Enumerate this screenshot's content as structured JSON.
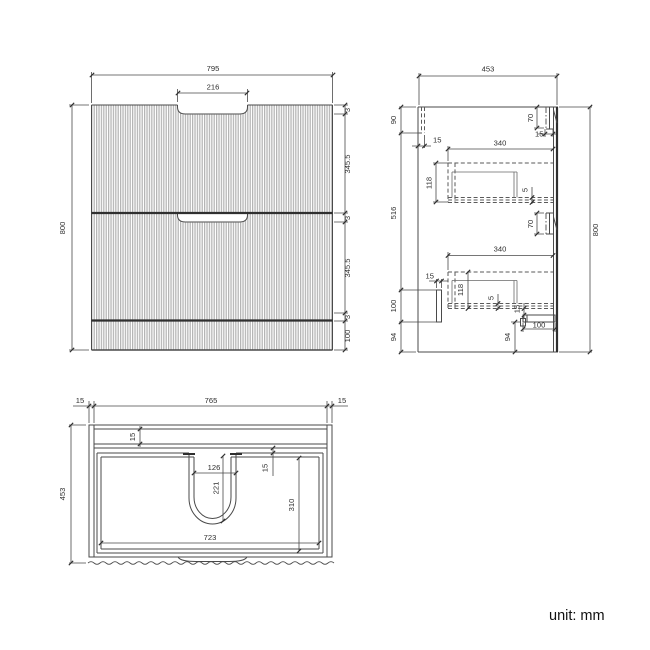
{
  "front_view": {
    "width": "795",
    "handle_cutout_width": "216",
    "height": "800",
    "gap_top": "3",
    "drawer1_height": "345.5",
    "gap_middle": "3",
    "drawer2_height": "345.5",
    "gap_bottom": "3",
    "plinth_height": "100"
  },
  "side_view": {
    "depth": "453",
    "height": "800",
    "back_rail_height": "90",
    "mid_section_height": "516",
    "bottom_rail_height": "100",
    "base_height": "94",
    "back_rail_thickness": "15",
    "handle1_height": "70",
    "handle_depth": "15",
    "drawer1_length": "340",
    "drawer1_inner_height": "118",
    "drawer1_bottom_gap": "5",
    "handle2_height": "70",
    "drawer2_length": "340",
    "drawer2_inner_height": "118",
    "drawer2_bottom_gap": "5",
    "drawer2_front_gap": "15",
    "bottom_rail_width": "15",
    "runner_length": "100",
    "plinth_height": "94"
  },
  "plan_view": {
    "side_thickness_left": "15",
    "inner_width": "765",
    "side_thickness_right": "15",
    "depth": "453",
    "top_rail_thickness": "15",
    "back_gap": "15",
    "cutout_width": "126",
    "cutout_depth": "221",
    "drawer_inner_depth": "310",
    "inner_length": "723"
  },
  "footer": {
    "unit_label": "unit: mm"
  }
}
